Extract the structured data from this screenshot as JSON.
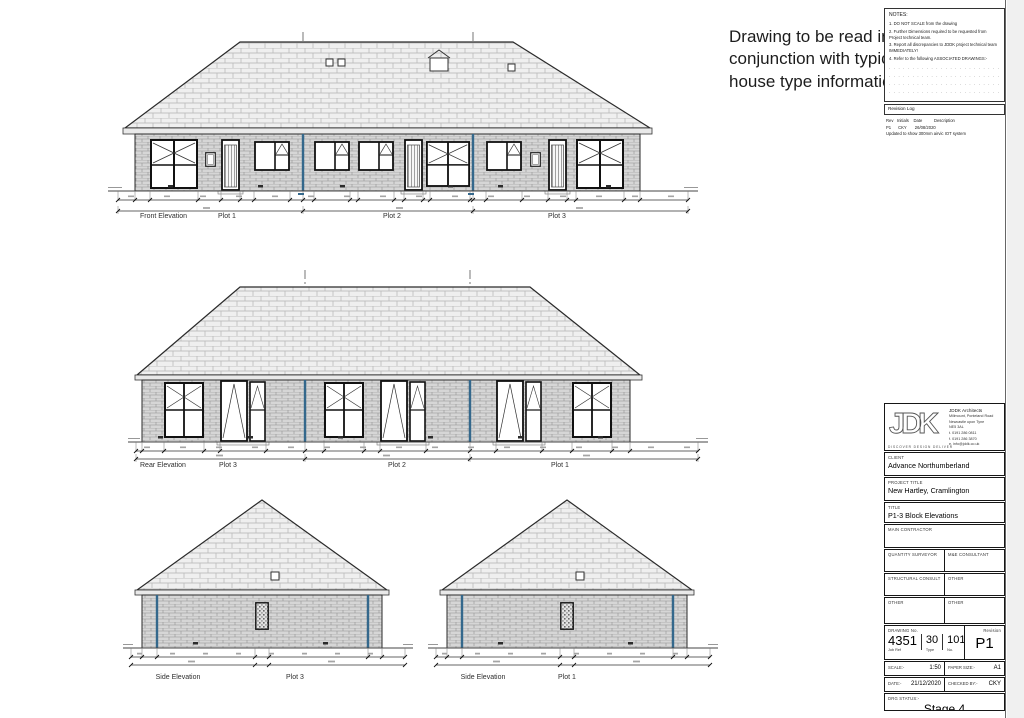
{
  "callout": "Drawing to be read in conjunction with typical house type information",
  "notes_panel": {
    "title": "NOTES:",
    "items": [
      "1. DO NOT SCALE from the drawing",
      "2. Further Dimensions required to be requested from Project technical team.",
      "3. Report all discrepancies to JDDK project technical team IMMEDIATELY!",
      "4. Refer to the following ASSOCIATED DRAWINGS:-"
    ],
    "dots": ". . . . . . . . . . . . . . . . . . . . . . . . . . . . . . . . . . . ."
  },
  "revision_log": {
    "title": "Revision Log",
    "header": "Rev   Initials    Date          Description",
    "row": "P1      CKY       26/08/2020",
    "row_desc": "Updated to show 300mm airvic IOT system"
  },
  "elevations": {
    "front": {
      "label": "Front Elevation",
      "plots": [
        "Plot 1",
        "Plot 2",
        "Plot 3"
      ]
    },
    "rear": {
      "label": "Rear Elevation",
      "plots": [
        "Plot 3",
        "Plot 2",
        "Plot 1"
      ]
    },
    "side_left": {
      "label": "Side Elevation",
      "plot": "Plot 3"
    },
    "side_right": {
      "label": "Side Elevation",
      "plot": "Plot 1"
    }
  },
  "title_block": {
    "logo": "JDK",
    "tagline": "DISCOVER DESIGN DELIVER",
    "firm_name": "JDDK Architects",
    "address": [
      "Millmount, Ponteland Road",
      "Newcastle upon Tyne",
      "NE5 3AL"
    ],
    "contacts": [
      "t. 0191 286 0811",
      "f. 0191 286 3870",
      "e. info@jddk.co.uk"
    ],
    "web": "jddk.co.uk",
    "client_label": "CLIENT",
    "client": "Advance Northumberland",
    "project_label": "PROJECT TITLE",
    "project": "New Hartley, Cramlington",
    "title_label": "TITLE",
    "title": "P1-3 Block Elevations",
    "main_contractor_label": "MAIN CONTRACTOR",
    "consultants": [
      "QUANTITY SURVEYOR",
      "M&E CONSULTANT",
      "STRUCTURAL CONSULT",
      "OTHER",
      "OTHER",
      "OTHER"
    ],
    "drawing_no_label": "DRAWING No.",
    "job_ref": "4351",
    "job_ref_label": "Job Ref",
    "type": "30",
    "type_label": "Type",
    "no": "101",
    "no_label": "No.",
    "revision_label": "Revision",
    "revision": "P1",
    "scale_label": "SCALE:-",
    "scale": "1:50",
    "paper_label": "PAPER SIZE:-",
    "paper": "A1",
    "date_label": "DATE:-",
    "date": "21/12/2020",
    "checked_label": "CHECKED BY:-",
    "checked": "CKY",
    "status_label": "DRG STATUS:-",
    "status": "Stage 4"
  },
  "colors": {
    "party_wall_blue": "#34688c"
  }
}
